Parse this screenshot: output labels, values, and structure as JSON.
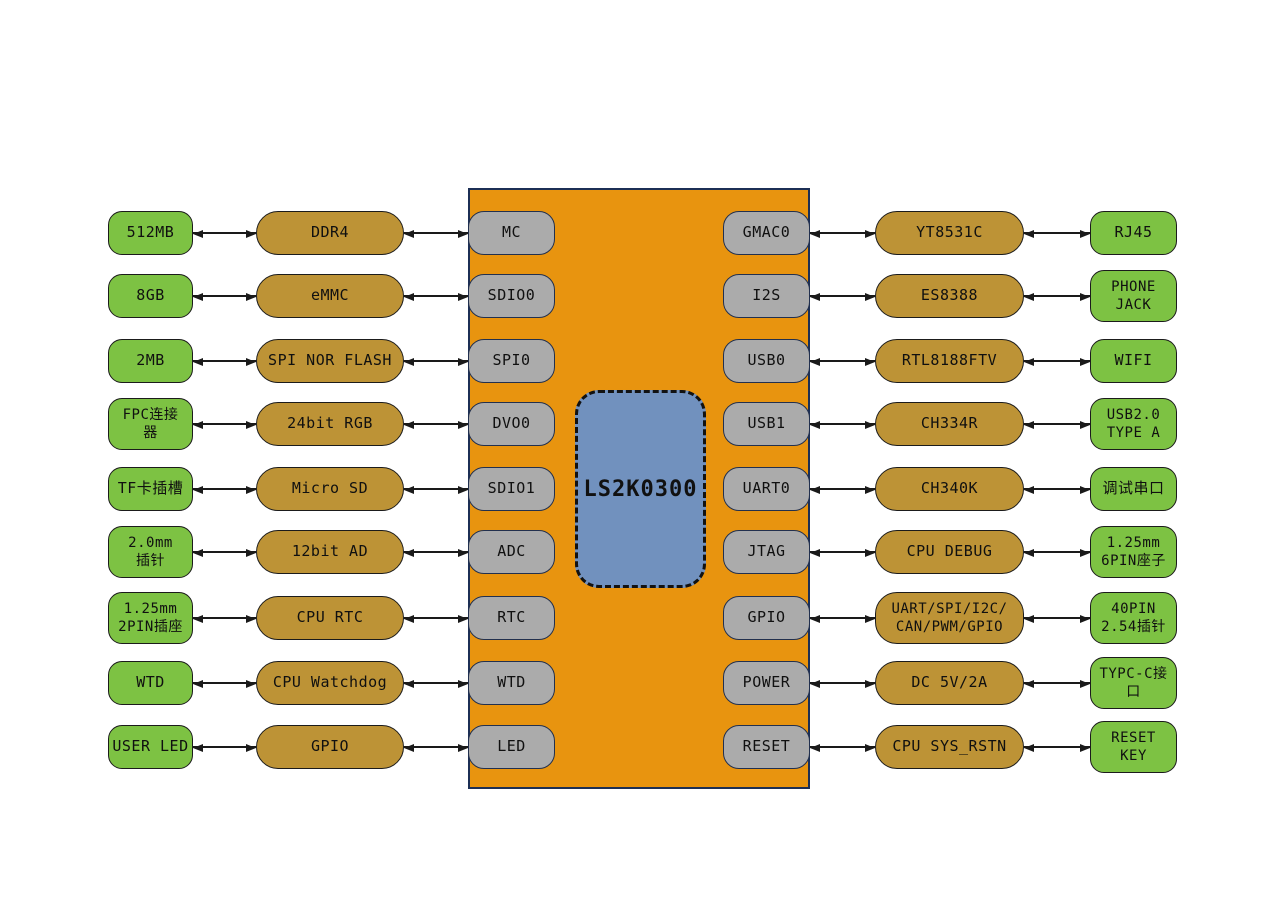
{
  "diagram": {
    "title": "LS2K0300 board block diagram",
    "chip": {
      "label": "LS2K0300"
    },
    "colors": {
      "soc_block": "#E8940F",
      "connector_box": "#7DC243",
      "module_box": "#BD9336",
      "port_pill": "#ABABAB",
      "chip_box": "#7191BE"
    },
    "rows": [
      {
        "outer_left": "512MB",
        "module_left": "DDR4",
        "port_left": "MC",
        "port_right": "GMAC0",
        "module_right": "YT8531C",
        "outer_right": "RJ45"
      },
      {
        "outer_left": "8GB",
        "module_left": "eMMC",
        "port_left": "SDIO0",
        "port_right": "I2S",
        "module_right": "ES8388",
        "outer_right": "PHONE\nJACK"
      },
      {
        "outer_left": "2MB",
        "module_left": "SPI NOR FLASH",
        "port_left": "SPI0",
        "port_right": "USB0",
        "module_right": "RTL8188FTV",
        "outer_right": "WIFI"
      },
      {
        "outer_left": "FPC连接\n器",
        "module_left": "24bit RGB",
        "port_left": "DVO0",
        "port_right": "USB1",
        "module_right": "CH334R",
        "outer_right": "USB2.0\nTYPE A"
      },
      {
        "outer_left": "TF卡插槽",
        "module_left": "Micro SD",
        "port_left": "SDIO1",
        "port_right": "UART0",
        "module_right": "CH340K",
        "outer_right": "调试串口"
      },
      {
        "outer_left": "2.0mm\n插针",
        "module_left": "12bit AD",
        "port_left": "ADC",
        "port_right": "JTAG",
        "module_right": "CPU DEBUG",
        "outer_right": "1.25mm\n6PIN座子"
      },
      {
        "outer_left": "1.25mm\n2PIN插座",
        "module_left": "CPU RTC",
        "port_left": "RTC",
        "port_right": "GPIO",
        "module_right": "UART/SPI/I2C/\nCAN/PWM/GPIO",
        "outer_right": "40PIN\n2.54插针"
      },
      {
        "outer_left": "WTD",
        "module_left": "CPU Watchdog",
        "port_left": "WTD",
        "port_right": "POWER",
        "module_right": "DC 5V/2A",
        "outer_right": "TYPC-C接\n口"
      },
      {
        "outer_left": "USER LED",
        "module_left": "GPIO",
        "port_left": "LED",
        "port_right": "RESET",
        "module_right": "CPU SYS_RSTN",
        "outer_right": "RESET\nKEY"
      }
    ]
  }
}
